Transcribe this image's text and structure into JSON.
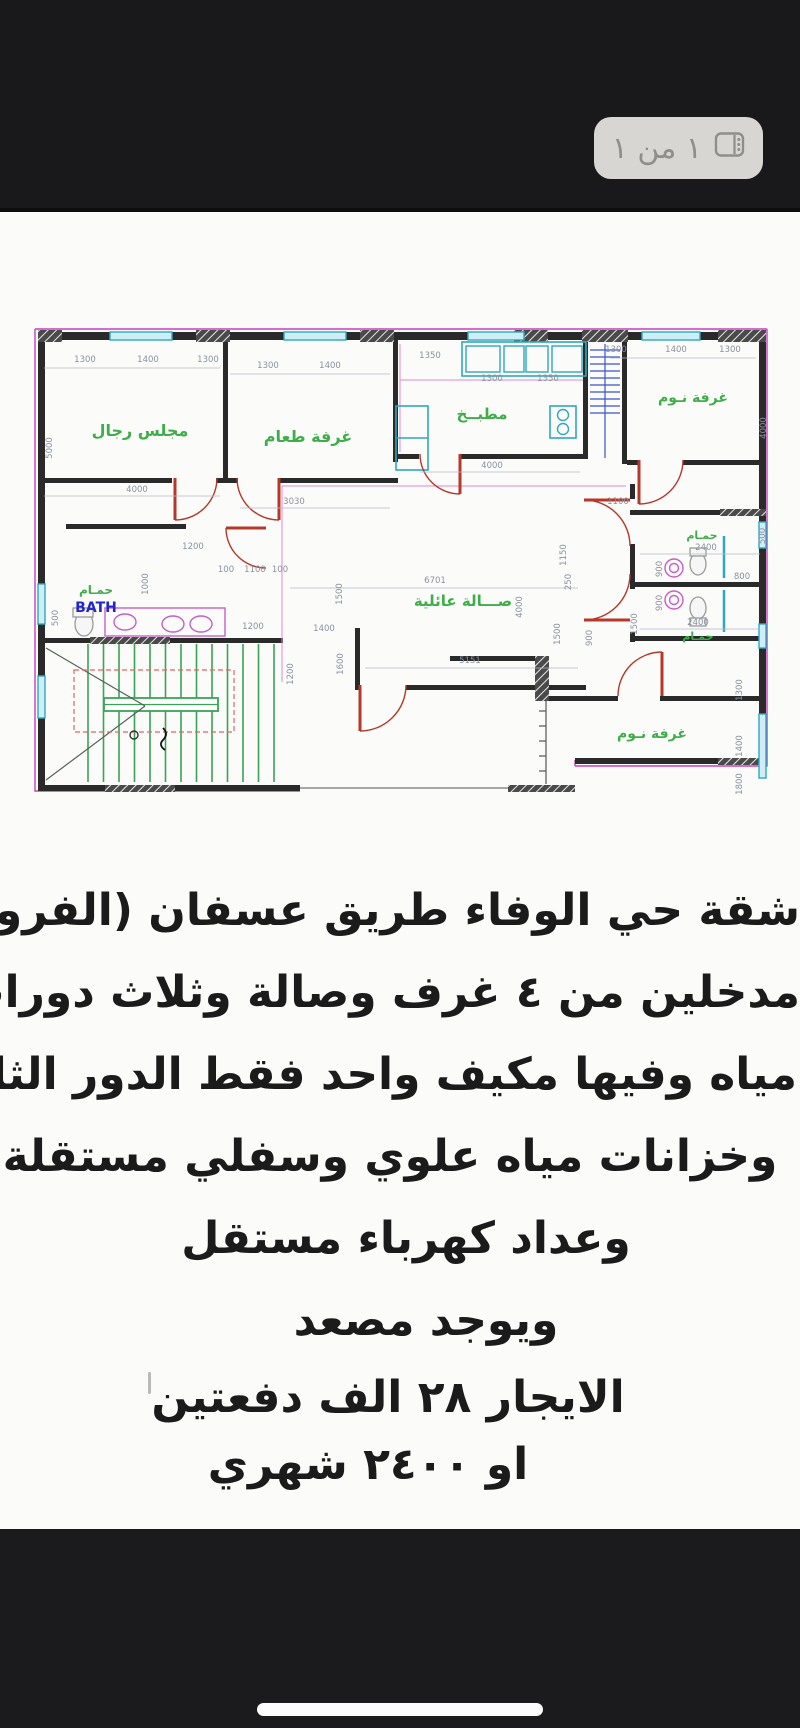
{
  "viewer": {
    "page_badge": "١ من ١"
  },
  "plan": {
    "colors": {
      "wall": "#2a2a2a",
      "outline": "#c840bd",
      "window": "#2fa8bd",
      "door": "#b5382b",
      "label": "#3fae4a",
      "fixture": "#c65fc6",
      "stairs": "#3aa357",
      "dim": "#8b90a0",
      "bathblue": "#2326c8"
    },
    "bath_en": "BATH",
    "rooms": [
      {
        "label": "مجلس رجال",
        "x": 110,
        "y": 148,
        "s": 16
      },
      {
        "label": "غرفة طعام",
        "x": 278,
        "y": 154,
        "s": 16
      },
      {
        "label": "مطبــخ",
        "x": 452,
        "y": 131,
        "s": 15
      },
      {
        "label": "غرفة نـوم",
        "x": 663,
        "y": 114,
        "s": 14
      },
      {
        "label": "صـــالة عائلية",
        "x": 433,
        "y": 318,
        "s": 15
      },
      {
        "label": "حمـام",
        "x": 66,
        "y": 306,
        "s": 12
      },
      {
        "label": "حمـام",
        "x": 672,
        "y": 251,
        "s": 11
      },
      {
        "label": "حمـام",
        "x": 668,
        "y": 352,
        "s": 11
      },
      {
        "label": "غرفة نـوم",
        "x": 622,
        "y": 450,
        "s": 14
      }
    ],
    "dims": [
      {
        "t": "1300",
        "x": 55,
        "y": 74,
        "r": 0
      },
      {
        "t": "1400",
        "x": 118,
        "y": 74,
        "r": 0
      },
      {
        "t": "1300",
        "x": 178,
        "y": 74,
        "r": 0
      },
      {
        "t": "1300",
        "x": 238,
        "y": 80,
        "r": 0
      },
      {
        "t": "1400",
        "x": 300,
        "y": 80,
        "r": 0
      },
      {
        "t": "1350",
        "x": 400,
        "y": 70,
        "r": 0
      },
      {
        "t": "1300",
        "x": 462,
        "y": 93,
        "r": 0
      },
      {
        "t": "1350",
        "x": 518,
        "y": 93,
        "r": 0
      },
      {
        "t": "1300",
        "x": 586,
        "y": 64,
        "r": 0
      },
      {
        "t": "1400",
        "x": 646,
        "y": 64,
        "r": 0
      },
      {
        "t": "1300",
        "x": 700,
        "y": 64,
        "r": 0
      },
      {
        "t": "5000",
        "x": 22,
        "y": 160,
        "r": 90
      },
      {
        "t": "4000",
        "x": 107,
        "y": 204,
        "r": 0
      },
      {
        "t": "3030",
        "x": 264,
        "y": 216,
        "r": 0
      },
      {
        "t": "4000",
        "x": 462,
        "y": 180,
        "r": 0
      },
      {
        "t": "4000",
        "x": 736,
        "y": 140,
        "r": 90
      },
      {
        "t": "1200",
        "x": 163,
        "y": 261,
        "r": 0
      },
      {
        "t": "100",
        "x": 196,
        "y": 284,
        "r": 0
      },
      {
        "t": "1100",
        "x": 225,
        "y": 284,
        "r": 0
      },
      {
        "t": "100",
        "x": 250,
        "y": 284,
        "r": 0
      },
      {
        "t": "1000",
        "x": 118,
        "y": 296,
        "r": 90
      },
      {
        "t": "500",
        "x": 28,
        "y": 330,
        "r": 90
      },
      {
        "t": "1200",
        "x": 223,
        "y": 341,
        "r": 0
      },
      {
        "t": "6701",
        "x": 405,
        "y": 295,
        "r": 0
      },
      {
        "t": "5151",
        "x": 440,
        "y": 375,
        "r": 0
      },
      {
        "t": "4000",
        "x": 492,
        "y": 319,
        "r": 90
      },
      {
        "t": "1150",
        "x": 536,
        "y": 267,
        "r": 90
      },
      {
        "t": "250",
        "x": 541,
        "y": 294,
        "r": 90
      },
      {
        "t": "1100",
        "x": 588,
        "y": 216,
        "r": 0
      },
      {
        "t": "2400",
        "x": 676,
        "y": 262,
        "r": 0
      },
      {
        "t": "2400",
        "x": 668,
        "y": 337,
        "r": 0
      },
      {
        "t": "900",
        "x": 632,
        "y": 281,
        "r": 90
      },
      {
        "t": "800",
        "x": 712,
        "y": 291,
        "r": 0
      },
      {
        "t": "500",
        "x": 735,
        "y": 248,
        "r": 90
      },
      {
        "t": "900",
        "x": 632,
        "y": 315,
        "r": 90
      },
      {
        "t": "1500",
        "x": 607,
        "y": 336,
        "r": 90
      },
      {
        "t": "1400",
        "x": 294,
        "y": 343,
        "r": 0
      },
      {
        "t": "1600",
        "x": 313,
        "y": 376,
        "r": 90
      },
      {
        "t": "1500",
        "x": 312,
        "y": 306,
        "r": 90
      },
      {
        "t": "1200",
        "x": 263,
        "y": 386,
        "r": 90
      },
      {
        "t": "1500",
        "x": 530,
        "y": 346,
        "r": 90
      },
      {
        "t": "900",
        "x": 562,
        "y": 350,
        "r": 90
      },
      {
        "t": "1300",
        "x": 712,
        "y": 402,
        "r": 90
      },
      {
        "t": "1400",
        "x": 712,
        "y": 458,
        "r": 90
      },
      {
        "t": "1800",
        "x": 712,
        "y": 496,
        "r": 90
      }
    ]
  },
  "ad": {
    "lines": [
      {
        "text": "شقة حي الوفاء طريق عسفان (الفروسية)",
        "top": 887,
        "dx": 0
      },
      {
        "text": "مدخلين من ٤ غرف وصالة وثلاث دورات",
        "top": 969,
        "dx": 0
      },
      {
        "text": "مياه وفيها مكيف واحد فقط  الدور الثالث",
        "top": 1051,
        "dx": -3
      },
      {
        "text": "وخزانات مياه علوي وسفلي مستقلة",
        "top": 1133,
        "dx": -10
      },
      {
        "text": "وعداد كهرباء مستقل",
        "top": 1215,
        "dx": 6
      },
      {
        "text": "ويوجد مصعد",
        "top": 1297,
        "dx": 26
      },
      {
        "text": "الايجار  ٢٨ الف دفعتين",
        "top": 1374,
        "dx": -12
      },
      {
        "text": "او ٢٤٠٠ شهري",
        "top": 1441,
        "dx": -32
      }
    ]
  }
}
